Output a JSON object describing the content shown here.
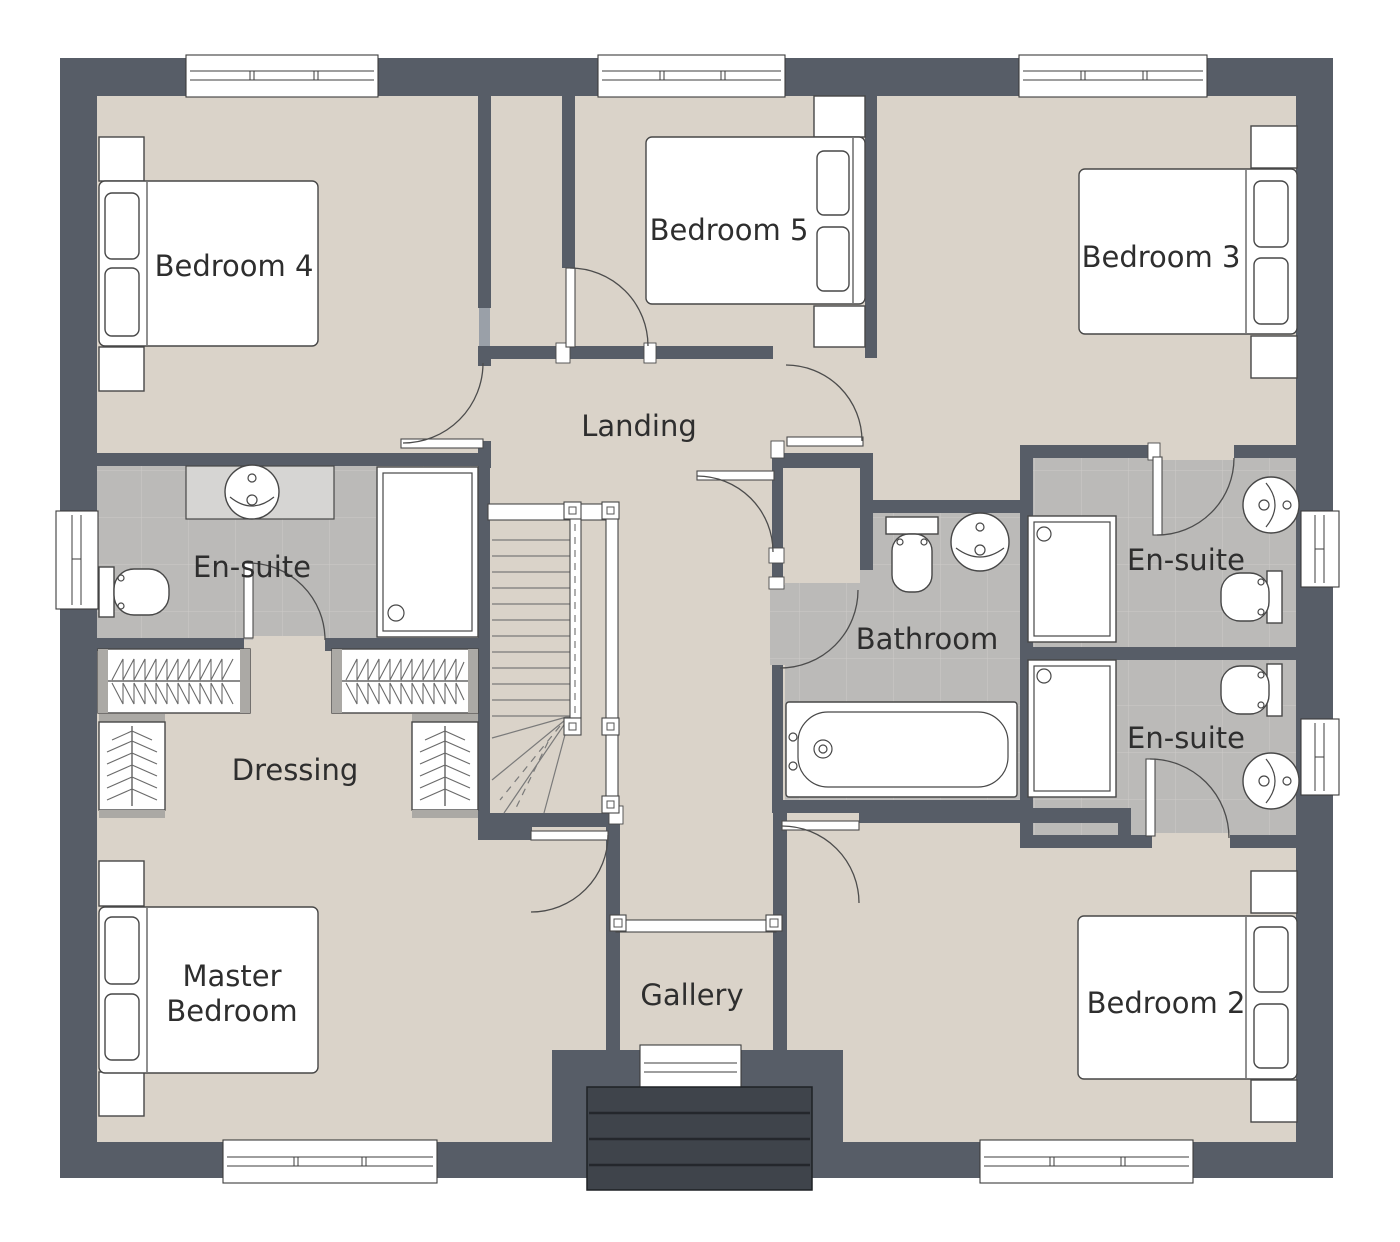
{
  "rooms": {
    "bedroom4": {
      "label": "Bedroom 4"
    },
    "bedroom5": {
      "label": "Bedroom 5"
    },
    "bedroom3": {
      "label": "Bedroom 3"
    },
    "landing": {
      "label": "Landing"
    },
    "ensuite_left": {
      "label": "En-suite"
    },
    "bathroom": {
      "label": "Bathroom"
    },
    "ensuite_top_right": {
      "label": "En-suite"
    },
    "ensuite_bottom_right": {
      "label": "En-suite"
    },
    "dressing": {
      "label": "Dressing"
    },
    "master_bedroom": {
      "label": "Master Bedroom",
      "line1": "Master",
      "line2": "Bedroom"
    },
    "gallery": {
      "label": "Gallery"
    },
    "bedroom2": {
      "label": "Bedroom 2"
    }
  },
  "icons": {
    "bed": "outline-rect-with-pillows",
    "toilet": "tank-and-bowl-outline",
    "sink": "round-basin-outline",
    "bathtub": "rect-tub-outline",
    "shower": "square-tray-outline",
    "wardrobe_rail": "zigzag-hanging-rail",
    "shelf_unit": "chevron-stack",
    "stairs": "treads-with-winders",
    "door": "quarter-arc-swing",
    "window": "triple-pane-bar",
    "railing": "bar-with-posts",
    "canopy": "striped-dark-roof"
  },
  "colors": {
    "wall": "#575D67",
    "floor": "#DAD3C9",
    "tile": "#BBBAB8",
    "tileLine": "#CCCBC8",
    "fixtureStroke": "#474747",
    "counter": "#D6D5D3",
    "canopy": "#3F444B",
    "canopyLine": "#24272C",
    "wardrobeCap": "#ABA9A5",
    "lightWallStrip": "#9AA0A8",
    "text": "#2E2E2E",
    "background": "#FFFFFF"
  }
}
